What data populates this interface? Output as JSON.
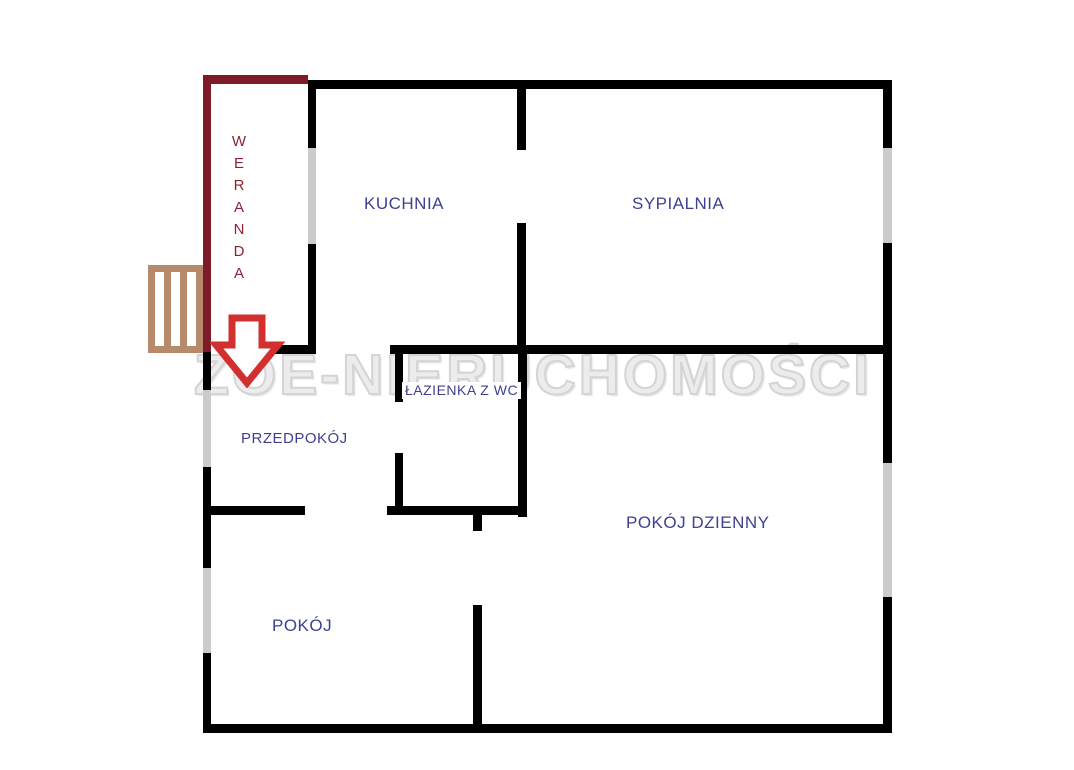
{
  "watermark": {
    "text": "ZOE-NIERUCHOMOŚCI"
  },
  "rooms": [
    {
      "id": "weranda",
      "label": "WERANDA"
    },
    {
      "id": "kuchnia",
      "label": "KUCHNIA"
    },
    {
      "id": "sypialnia",
      "label": "SYPIALNIA"
    },
    {
      "id": "lazienka",
      "label": "ŁAZIENKA Z WC"
    },
    {
      "id": "przedpokoj",
      "label": "PRZEDPOKÓJ"
    },
    {
      "id": "pokoj-dzienny",
      "label": "POKÓJ DZIENNY"
    },
    {
      "id": "pokoj",
      "label": "POKÓJ"
    }
  ],
  "colors": {
    "wall": "#000000",
    "veranda_wall": "#7d1b28",
    "veranda_text": "#8c2433",
    "window": "#cbcbcb",
    "stairs": "#b78a6c",
    "arrow": "#d22f2f",
    "room_label": "#3e4191",
    "watermark_fill": "#ececec",
    "watermark_stroke": "#d4d4d4"
  },
  "geometry": {
    "black_walls": [
      [
        308,
        80,
        584,
        9
      ],
      [
        883,
        80,
        9,
        68
      ],
      [
        883,
        243,
        9,
        220
      ],
      [
        883,
        597,
        9,
        136
      ],
      [
        203,
        724,
        689,
        9
      ],
      [
        203,
        348,
        8,
        42
      ],
      [
        203,
        467,
        8,
        101
      ],
      [
        203,
        653,
        8,
        80
      ],
      [
        308,
        80,
        8,
        68
      ],
      [
        308,
        244,
        8,
        108
      ],
      [
        275,
        345,
        41,
        9
      ],
      [
        390,
        345,
        502,
        9
      ],
      [
        517,
        80,
        9,
        70
      ],
      [
        517,
        223,
        9,
        131
      ],
      [
        395,
        345,
        8,
        57
      ],
      [
        395,
        453,
        8,
        60
      ],
      [
        518,
        345,
        9,
        172
      ],
      [
        387,
        506,
        140,
        9
      ],
      [
        203,
        506,
        102,
        9
      ],
      [
        473,
        514,
        9,
        17
      ],
      [
        473,
        605,
        9,
        128
      ]
    ],
    "veranda_walls": [
      [
        203,
        75,
        8,
        277
      ],
      [
        203,
        75,
        105,
        9
      ]
    ],
    "windows": [
      [
        308,
        148,
        8,
        96
      ],
      [
        883,
        148,
        9,
        95
      ],
      [
        883,
        463,
        9,
        134
      ],
      [
        203,
        390,
        8,
        77
      ],
      [
        203,
        568,
        8,
        85
      ]
    ],
    "stairs": {
      "x": 148,
      "y": 265,
      "w": 55,
      "h": 88
    },
    "arrow": {
      "x": 210,
      "y": 312,
      "w": 76,
      "h": 76,
      "points": "22,6 52,6 52,33 68,33 37,71 6,33 22,33"
    }
  }
}
